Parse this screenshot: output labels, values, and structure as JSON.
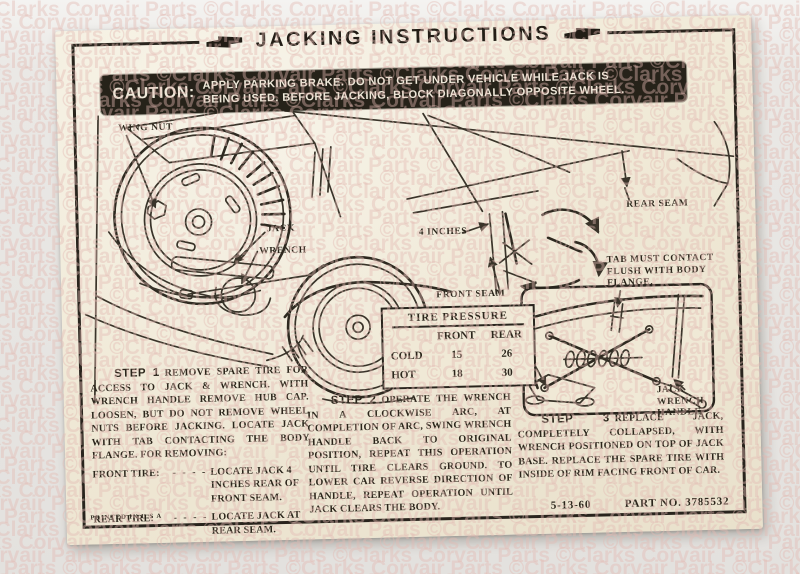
{
  "photo": {
    "watermark_text": "©Clarks Corvair Parts "
  },
  "colors": {
    "paper": "#f0e9d6",
    "ink": "#29241d",
    "caution_bar_bg": "#262219",
    "background": "#e7e5e2",
    "watermark": "#e2bab2"
  },
  "decal": {
    "title": "JACKING INSTRUCTIONS",
    "caution": {
      "label": "CAUTION:",
      "line1": "APPLY PARKING BRAKE. DO NOT GET UNDER VEHICLE WHILE JACK IS",
      "line2": "BEING USED. BEFORE JACKING, BLOCK DIAGONALLY OPPOSITE WHEEL."
    },
    "diagram": {
      "wing_nut": "WING NUT",
      "jack": "JACK",
      "wrench": "WRENCH",
      "four_inches": "4 INCHES",
      "front_seam": "FRONT SEAM",
      "rear_seam": "REAR SEAM",
      "tab_line1": "TAB MUST CONTACT",
      "tab_line2": "FLUSH WITH BODY",
      "tab_line3": "FLANGE.",
      "jack_base_line1": "JACK",
      "jack_base_line2": "BASE",
      "handle_line1": "JACK",
      "handle_line2": "WRENCH",
      "handle_line3": "HANDLE"
    },
    "tire_pressure": {
      "title": "TIRE PRESSURE",
      "col_front": "FRONT",
      "col_rear": "REAR",
      "rows": [
        {
          "label": "COLD",
          "front": "15",
          "rear": "26"
        },
        {
          "label": "HOT",
          "front": "18",
          "rear": "30"
        }
      ]
    },
    "steps": [
      {
        "label": "STEP 1",
        "text": "REMOVE SPARE TIRE FOR ACCESS TO JACK & WRENCH.  WITH WRENCH HANDLE REMOVE HUB CAP.  LOOSEN, BUT DO NOT REMOVE WHEEL NUTS BEFORE JACKING.  LOCATE JACK WITH TAB CONTACTING THE BODY FLANGE.  FOR REMOVING:"
      },
      {
        "label": "STEP 2",
        "text": "OPERATE THE WRENCH IN A CLOCKWISE ARC, AT COMPLETION OF ARC, SWING WRENCH HANDLE BACK TO ORIGINAL POSITION, REPEAT THIS OPERATION UNTIL TIRE CLEARS GROUND.  TO LOWER CAR REVERSE DIRECTION OF HANDLE, REPEAT OPERATION UNTIL JACK CLEARS THE BODY."
      },
      {
        "label": "STEP 3",
        "text": "REPLACE JACK, COMPLETELY COLLAPSED, WITH WRENCH POSITIONED ON TOP OF JACK BASE.  REPLACE THE SPARE TIRE WITH INSIDE OF RIM FACING FRONT OF CAR."
      }
    ],
    "removal": {
      "front": {
        "label": "FRONT TIRE:",
        "dots": "- - - -",
        "text": "LOCATE JACK 4 INCHES REAR OF FRONT SEAM."
      },
      "rear": {
        "label": "REAR TIRE:",
        "dots": "- - - -",
        "text": "LOCATE JACK AT REAR SEAM."
      }
    },
    "footer": {
      "printed": "PRINTED IN U S A",
      "date": "5-13-60",
      "part": "PART NO. 3785532"
    }
  }
}
